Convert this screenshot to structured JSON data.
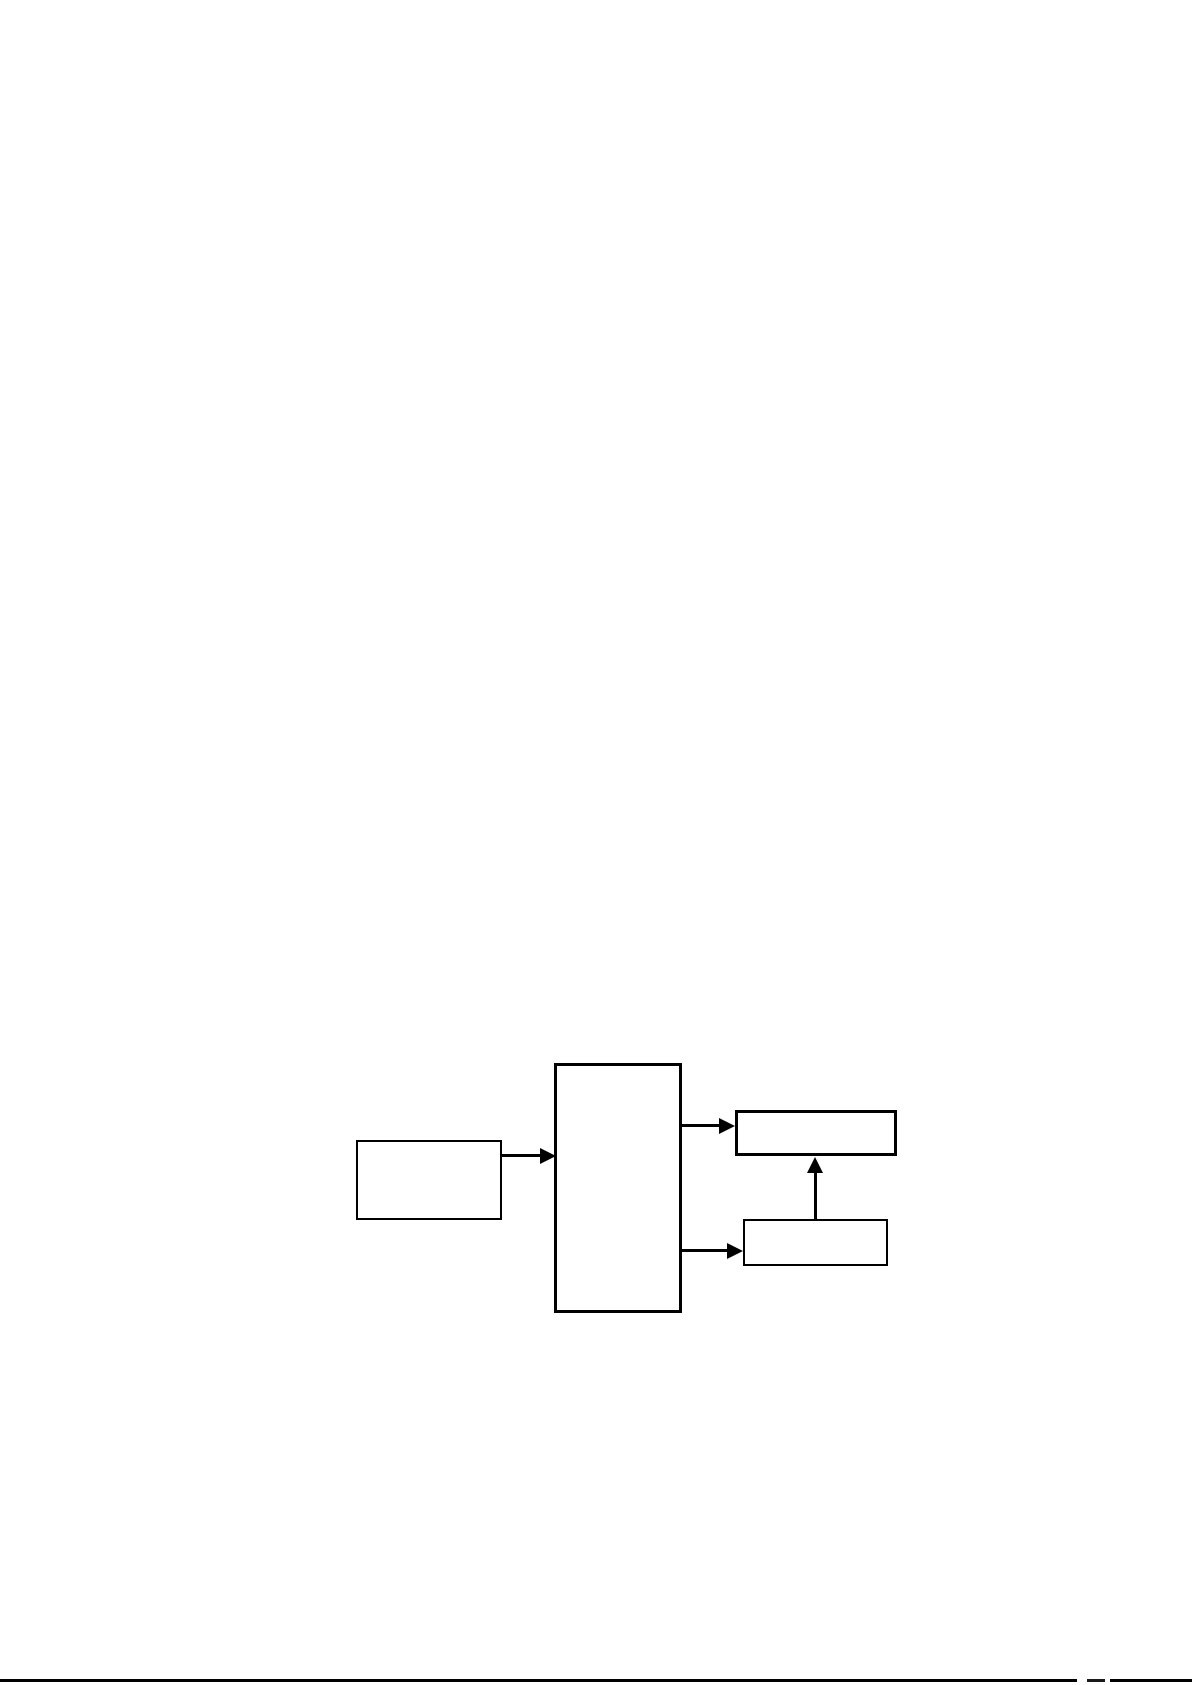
{
  "page": {
    "background_color": "#ffffff"
  },
  "diagram": {
    "type": "flowchart",
    "stroke_color": "#000000",
    "node_fill_color": "#ffffff",
    "nodes": [
      {
        "id": "left-box",
        "label": ""
      },
      {
        "id": "center-box",
        "label": ""
      },
      {
        "id": "top-right-box",
        "label": ""
      },
      {
        "id": "bottom-right-box",
        "label": ""
      }
    ],
    "connectors": [
      {
        "from": "left-box",
        "to": "center-box",
        "direction": "right",
        "head": "solid-triangle"
      },
      {
        "from": "center-box",
        "to": "top-right-box",
        "direction": "right",
        "head": "solid-triangle"
      },
      {
        "from": "center-box",
        "to": "bottom-right-box",
        "direction": "right",
        "head": "solid-triangle"
      },
      {
        "from": "bottom-right-box",
        "to": "top-right-box",
        "direction": "up",
        "head": "solid-triangle"
      }
    ]
  },
  "footer": {
    "rule_color": "#000000"
  }
}
